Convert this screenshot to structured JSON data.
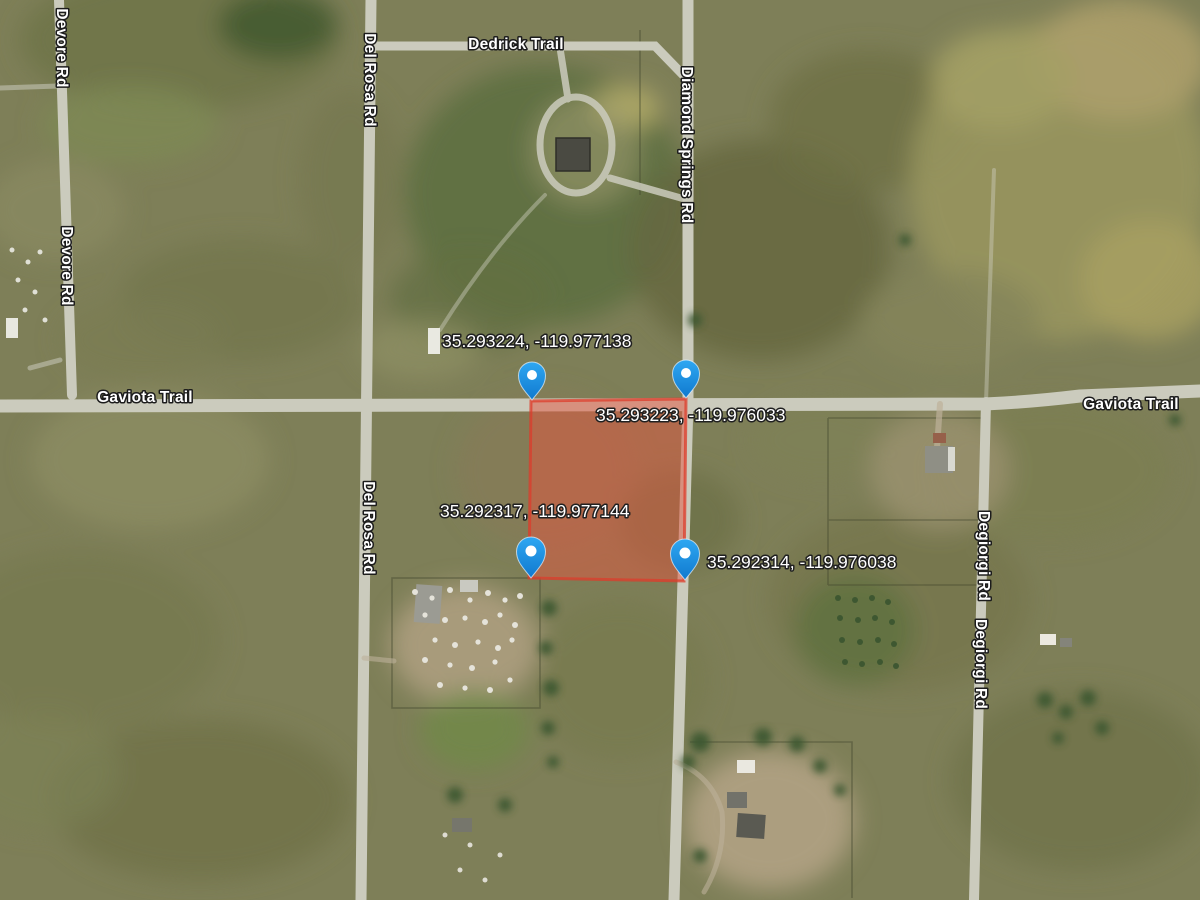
{
  "map": {
    "type": "satellite-parcel-view",
    "road_labels": {
      "dedrick_trail": "Dedrick Trail",
      "devore_rd": "Devore Rd",
      "del_rosa_rd": "Del Rosa Rd",
      "diamond_springs_rd": "Diamond Springs Rd",
      "gaviota_trail": "Gaviota Trail",
      "degiorgi_rd": "Degiorgi Rd"
    },
    "parcel": {
      "corners": [
        {
          "position": "northwest",
          "coordinates": "35.293224, -119.977138"
        },
        {
          "position": "northeast",
          "coordinates": "35.293223, -119.976033"
        },
        {
          "position": "southwest",
          "coordinates": "35.292317, -119.977144"
        },
        {
          "position": "southeast",
          "coordinates": "35.292314, -119.976038"
        }
      ]
    },
    "colors": {
      "pin_blue": "#1d96ea",
      "pin_blue_dark": "#1079ce",
      "parcel_fill": "#e4553f",
      "parcel_border": "#dd3c2b",
      "road_gray": "#cbcbbd",
      "terrain_base": "#7e7f58"
    }
  }
}
